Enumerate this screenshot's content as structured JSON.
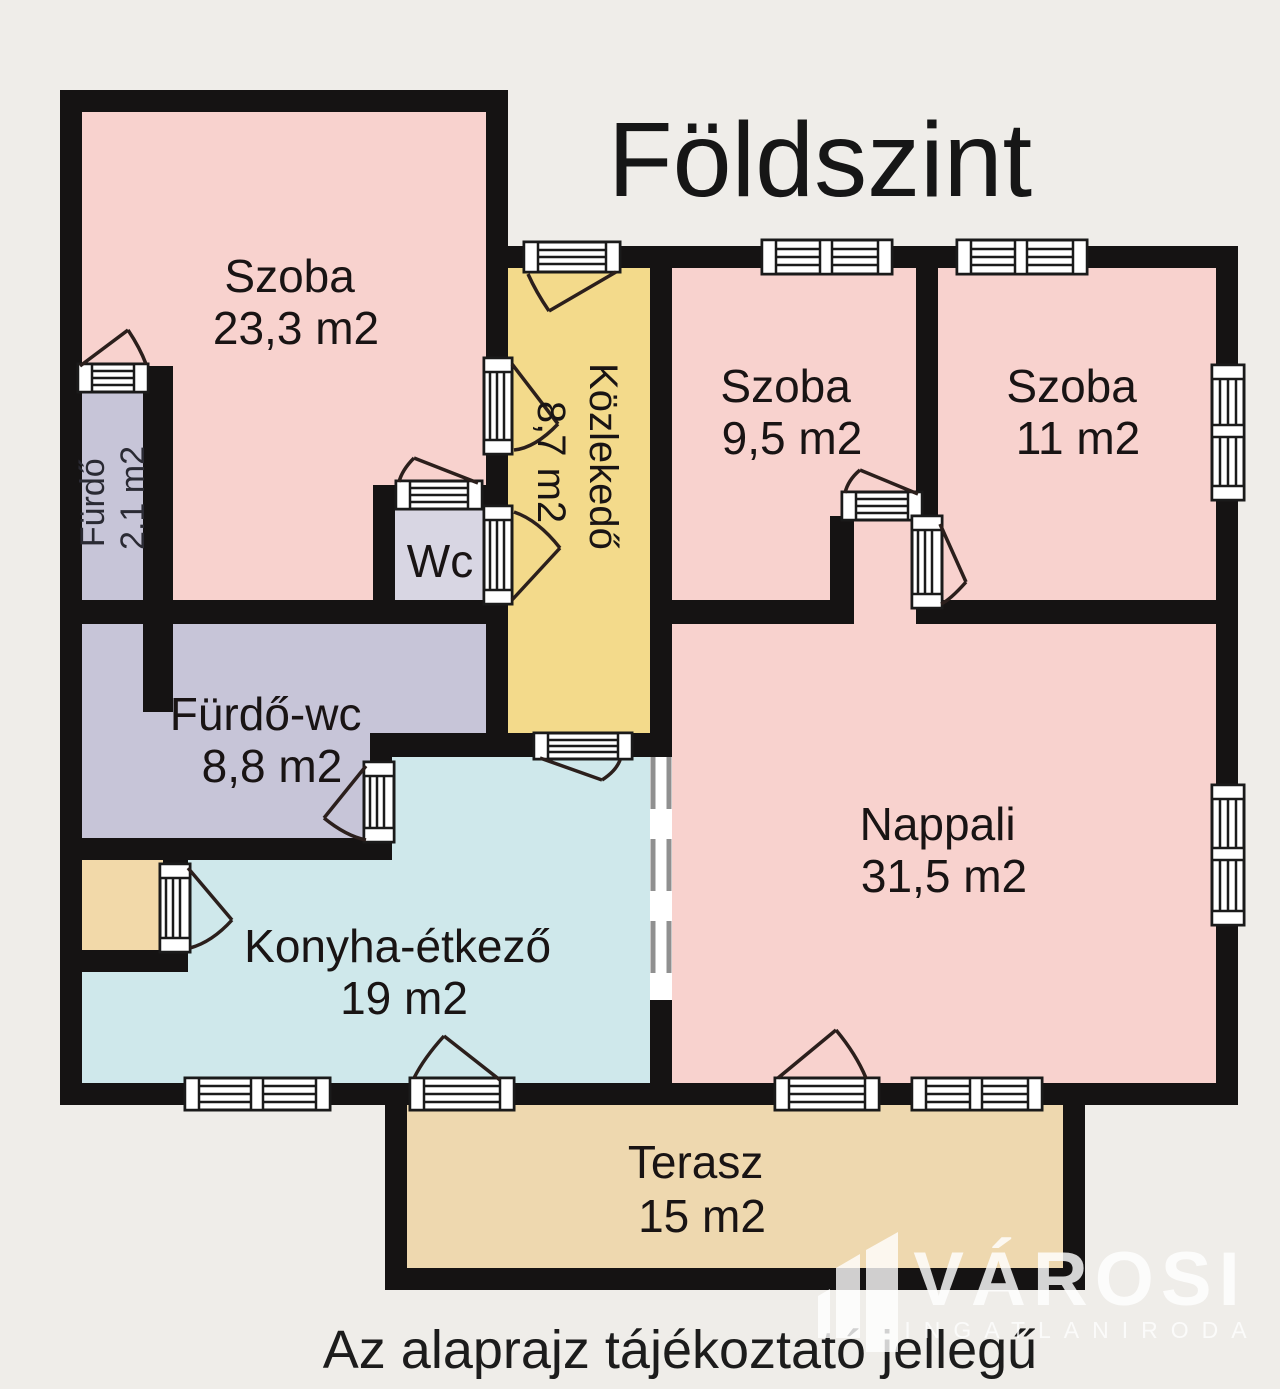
{
  "title": "Földszint",
  "caption": "Az alaprajz tájékoztató jellegű",
  "logo": {
    "name": "VÁROSI",
    "subtitle": "INGATLANIRODA"
  },
  "rooms": {
    "szoba1": {
      "name": "Szoba",
      "area": "23,3 m2"
    },
    "kozlekedo": {
      "name": "Közlekedő",
      "area": "8,7 m2"
    },
    "szoba2": {
      "name": "Szoba",
      "area": "9,5 m2"
    },
    "szoba3": {
      "name": "Szoba",
      "area": "11 m2"
    },
    "furdo": {
      "name": "Fürdő",
      "area": "2.1 m2"
    },
    "wc": {
      "name": "Wc"
    },
    "furdo_wc": {
      "name": "Fürdő-wc",
      "area": "8,8 m2"
    },
    "nappali": {
      "name": "Nappali",
      "area": "31,5 m2"
    },
    "konyha": {
      "name": "Konyha-étkező",
      "area": "19 m2"
    },
    "terasz": {
      "name": "Terasz",
      "area": "15 m2"
    }
  },
  "colors": {
    "room_pink": "#f8d2ce",
    "corridor_yellow": "#f3da8b",
    "bath_lavender": "#c7c5d8",
    "wc_lavender": "#d8d6e3",
    "kitchen_blue": "#cfe8eb",
    "terrace_tan": "#eed8af",
    "alcove_tan": "#f2d9a9",
    "wall_black": "#151313",
    "background": "#efede9"
  }
}
